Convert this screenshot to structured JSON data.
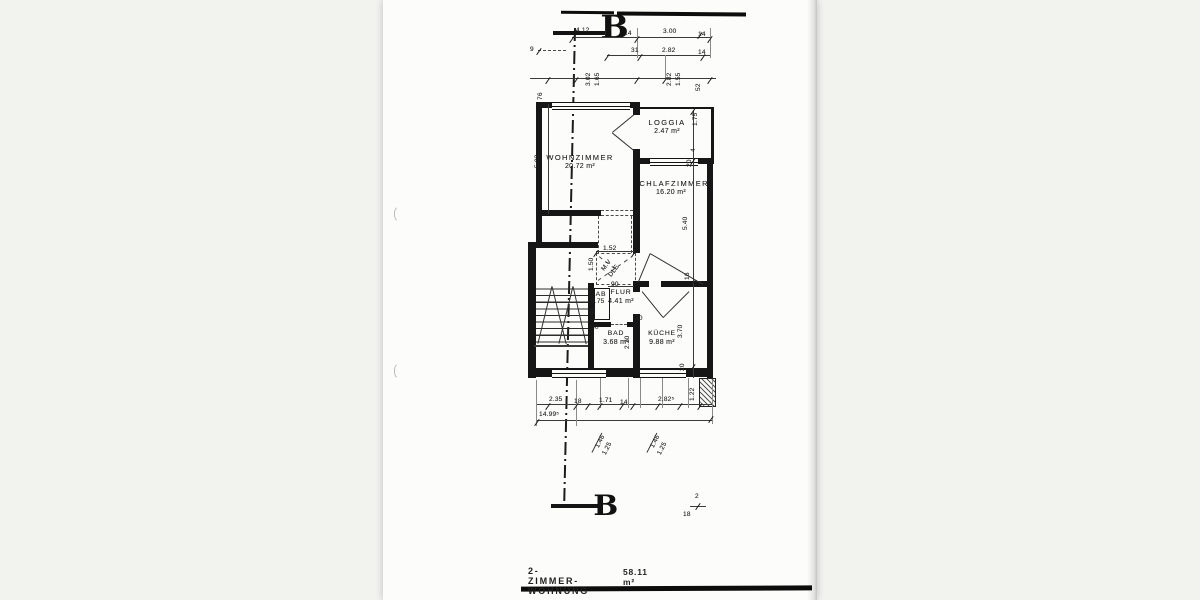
{
  "caption": {
    "title": "2-ZIMMER-WOHNUNG",
    "area": "58.11 m²"
  },
  "section_markers": {
    "top": "B",
    "bottom": "B"
  },
  "rooms": [
    {
      "name": "WOHNZIMMER",
      "area": "20.72 m²"
    },
    {
      "name": "LOGGIA",
      "area": "2.47 m²"
    },
    {
      "name": "SCHLAFZIMMER",
      "area": "16.20 m²"
    },
    {
      "name": "FLUR",
      "area": "4.41 m²"
    },
    {
      "name": "AB",
      "area": ""
    },
    {
      "name": "BAD",
      "area": "3.68 m²"
    },
    {
      "name": "KÜCHE",
      "area": "9.88 m²"
    }
  ],
  "dimensions": [
    {
      "t": "4.12",
      "x": 576,
      "y": 27
    },
    {
      "t": "14",
      "x": 624,
      "y": 30
    },
    {
      "t": "3.00",
      "x": 663,
      "y": 28
    },
    {
      "t": "14",
      "x": 698,
      "y": 31
    },
    {
      "t": "9",
      "x": 530,
      "y": 46
    },
    {
      "t": "31",
      "x": 631,
      "y": 47
    },
    {
      "t": "2.82",
      "x": 662,
      "y": 47
    },
    {
      "t": "14",
      "x": 698,
      "y": 49
    },
    {
      "t": "3.02",
      "x": 585,
      "y": 86,
      "r": -90
    },
    {
      "t": "1.65",
      "x": 594,
      "y": 86,
      "r": -90
    },
    {
      "t": "2.82",
      "x": 666,
      "y": 86,
      "r": -90
    },
    {
      "t": "1.55",
      "x": 675,
      "y": 86,
      "r": -90
    },
    {
      "t": "52",
      "x": 695,
      "y": 91,
      "r": -90
    },
    {
      "t": "76",
      "x": 537,
      "y": 100,
      "r": -90
    },
    {
      "t": "5.03",
      "x": 534,
      "y": 168,
      "r": -90
    },
    {
      "t": "1.75",
      "x": 692,
      "y": 126,
      "r": -90
    },
    {
      "t": "4",
      "x": 690,
      "y": 152,
      "r": -90
    },
    {
      "t": "20",
      "x": 686,
      "y": 167,
      "r": -90
    },
    {
      "t": "5.40",
      "x": 682,
      "y": 230,
      "r": -90
    },
    {
      "t": "16",
      "x": 684,
      "y": 280,
      "r": -90
    },
    {
      "t": "1.52",
      "x": 603,
      "y": 245
    },
    {
      "t": "1.50",
      "x": 588,
      "y": 271,
      "r": -90
    },
    {
      "t": "M.V",
      "x": 600,
      "y": 268,
      "r": -52
    },
    {
      "t": "DLE",
      "x": 607,
      "y": 274,
      "r": -52
    },
    {
      "t": "90",
      "x": 611,
      "y": 281
    },
    {
      "t": "0.75",
      "x": 591,
      "y": 298
    },
    {
      "t": "1.50",
      "x": 590,
      "y": 321,
      "r": -90
    },
    {
      "t": "50",
      "x": 591,
      "y": 324
    },
    {
      "t": "30",
      "x": 635,
      "y": 315
    },
    {
      "t": "2.20",
      "x": 624,
      "y": 349,
      "r": -90
    },
    {
      "t": "3.70",
      "x": 677,
      "y": 338,
      "r": -90
    },
    {
      "t": "20",
      "x": 679,
      "y": 371,
      "r": -90
    },
    {
      "t": "2.35",
      "x": 549,
      "y": 396
    },
    {
      "t": "18",
      "x": 574,
      "y": 398
    },
    {
      "t": "1.71",
      "x": 599,
      "y": 397
    },
    {
      "t": "14",
      "x": 620,
      "y": 399
    },
    {
      "t": "2.82⁵",
      "x": 658,
      "y": 396
    },
    {
      "t": "1.22",
      "x": 689,
      "y": 401,
      "r": -90
    },
    {
      "t": "14.99⁵",
      "x": 539,
      "y": 411
    },
    {
      "t": "1.46",
      "x": 594,
      "y": 446,
      "r": -63
    },
    {
      "t": "1.25",
      "x": 601,
      "y": 453,
      "r": -63
    },
    {
      "t": "1.46",
      "x": 649,
      "y": 446,
      "r": -63
    },
    {
      "t": "1.25",
      "x": 656,
      "y": 453,
      "r": -63
    },
    {
      "t": "2",
      "x": 695,
      "y": 493
    },
    {
      "t": "18",
      "x": 683,
      "y": 511
    }
  ]
}
